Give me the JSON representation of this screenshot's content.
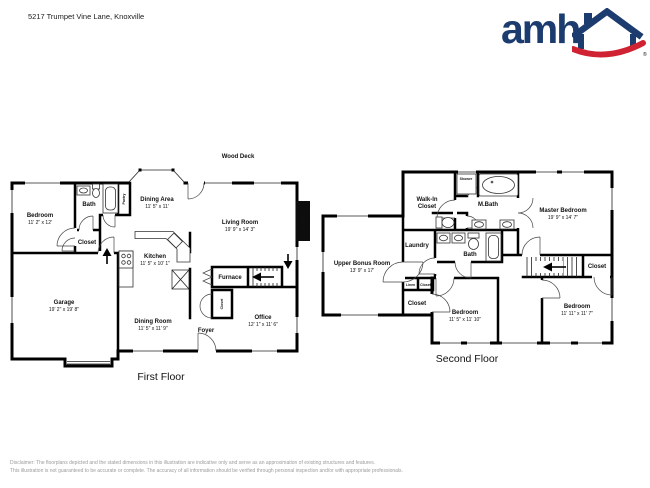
{
  "page": {
    "title": "5217 Trumpet Vine Lane, Knoxville"
  },
  "logo": {
    "wordmark": "amh",
    "navy": "#1c3b6e",
    "red": "#cf2233",
    "registered": "®"
  },
  "floor1": {
    "caption": "First Floor",
    "deck_label": "Wood Deck",
    "fireplace_label": "Fireplace",
    "rooms": {
      "bedroom": {
        "name": "Bedroom",
        "dims": "11' 2\" x 12'"
      },
      "bath": {
        "name": "Bath"
      },
      "pantry": {
        "name": "Pantry"
      },
      "closet": {
        "name": "Closet"
      },
      "dining_area": {
        "name": "Dining Area",
        "dims": "11' 5\" x 11'"
      },
      "living_room": {
        "name": "Living Room",
        "dims": "19' 9\" x 14' 3\""
      },
      "kitchen": {
        "name": "Kitchen",
        "dims": "11' 5\" x 10' 1\""
      },
      "furnace": {
        "name": "Furnace"
      },
      "hall_closet": {
        "name": "Closet"
      },
      "garage": {
        "name": "Garage",
        "dims": "19' 2\" x 19' 8\""
      },
      "dining_room": {
        "name": "Dining Room",
        "dims": "11' 5\" x 11' 9\""
      },
      "foyer": {
        "name": "Foyer"
      },
      "office": {
        "name": "Office",
        "dims": "12' 1\" x 11' 6\""
      }
    }
  },
  "floor2": {
    "caption": "Second Floor",
    "rooms": {
      "walk_in_closet": {
        "line1": "Walk-In",
        "line2": "Closet"
      },
      "shower": {
        "name": "Shower"
      },
      "master_bath": {
        "name": "M.Bath"
      },
      "master_bedroom": {
        "name": "Master Bedroom",
        "dims": "19' 9\" x 14' 7\""
      },
      "laundry": {
        "name": "Laundry"
      },
      "bath": {
        "name": "Bath"
      },
      "bonus": {
        "name": "Upper Bonus Room",
        "dims": "13' 9\" x 17'"
      },
      "linen": {
        "name": "Linen"
      },
      "closet_small": {
        "name": "Closet"
      },
      "closet_hall": {
        "name": "Closet"
      },
      "bedroom_left": {
        "name": "Bedroom",
        "dims": "11' 5\" x 11' 10\""
      },
      "bedroom_right": {
        "name": "Bedroom",
        "dims": "11' 11\" x 11' 7\""
      },
      "closet_stairs": {
        "name": "Closet"
      }
    }
  },
  "disclaimer": {
    "line1": "Disclaimer: The floorplans depicted and the stated dimensions in this illustration are indicative only and serve as an approximation of existing structures and features.",
    "line2": "This illustration is not guaranteed to be accurate or complete. The accuracy of all information should be verified through personal inspection and/or with appropriate professionals."
  }
}
